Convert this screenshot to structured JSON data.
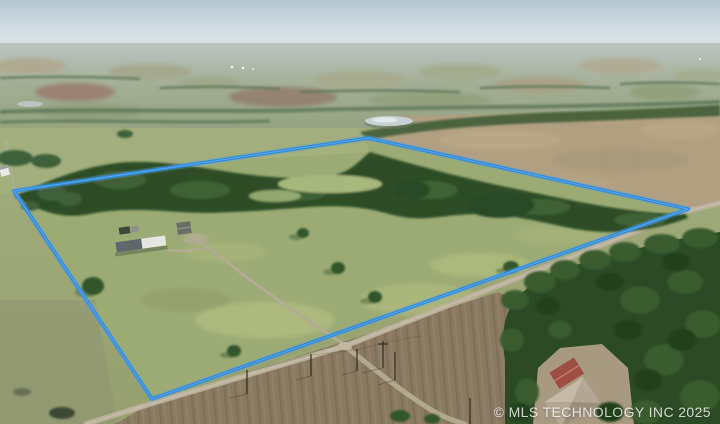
{
  "photo": {
    "description_label": "aerial-drone-photo-of-rural-acreage-with-outlined-parcel",
    "watermark": "© MLS TECHNOLOGY INC 2025"
  },
  "colors": {
    "boundary_stroke": "#2e8ade",
    "boundary_glow": "#5ba3e0",
    "boundary_highlight": "#8ec4f0",
    "sky_top": "#b7c7d3",
    "sky_horizon": "#e0e7ea",
    "pasture": "#9cab74",
    "tree_dark": "#2f4d28",
    "road": "#b9b19b",
    "plowed_field": "#8a7a62",
    "barn_roof": "#9e4f44",
    "house_roof": "#b3a895",
    "mobile_home_roof": "#e6e6e1",
    "pond": "#c7d0d2"
  }
}
